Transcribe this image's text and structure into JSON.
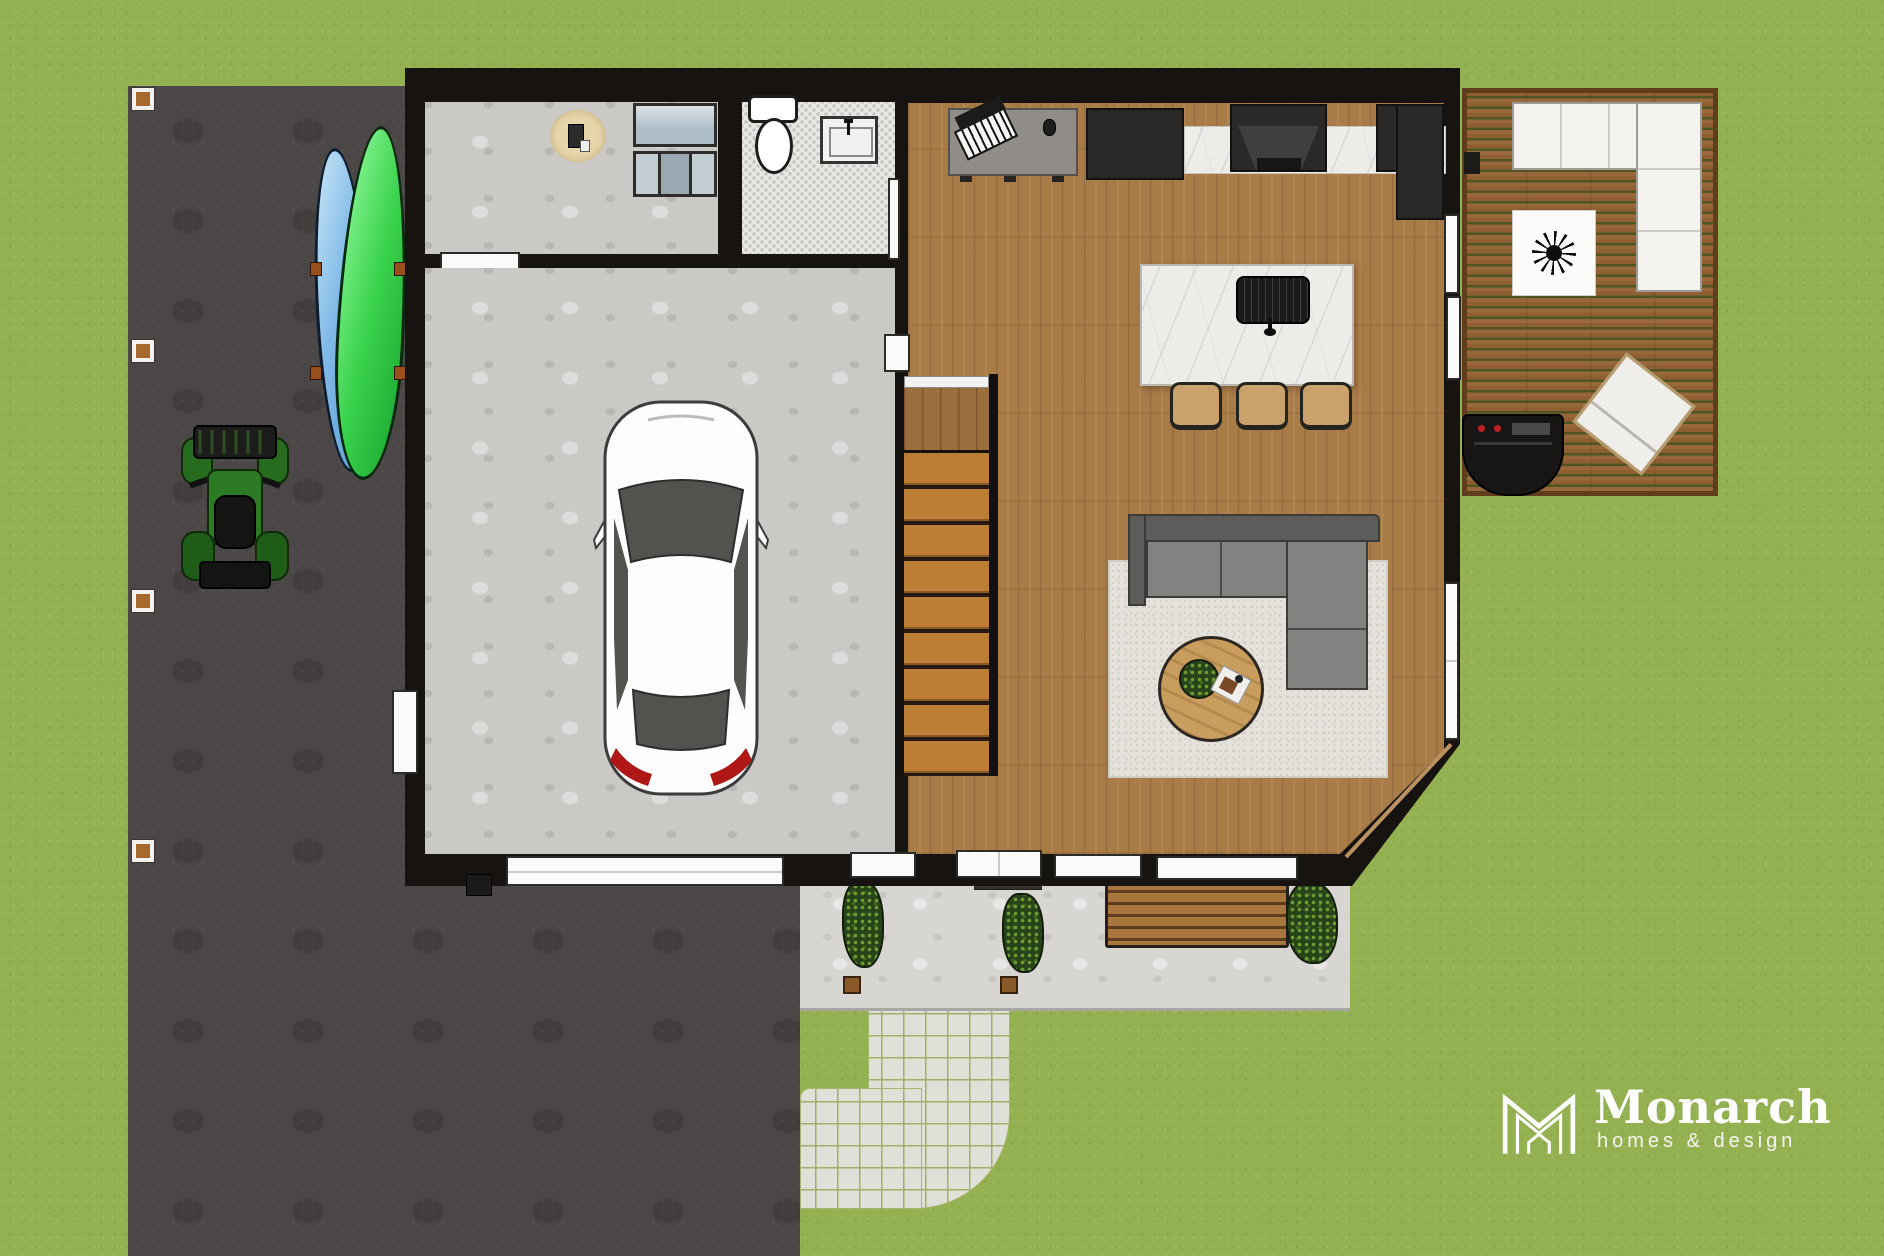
{
  "branding": {
    "logo_name": "Monarch",
    "logo_tagline": "homes & design",
    "logo_mark": "m-house-monogram-icon",
    "text_color": "#ffffff"
  },
  "palette": {
    "grass": "#94b151",
    "driveway_asphalt": "#4b4747",
    "wall_black": "#171311",
    "garage_concrete": "#cbc9c6",
    "porch_concrete": "#d8d6d2",
    "hardwood_floor": "#a87b47",
    "stair_tread": "#bc7e34",
    "bath_tile": "#e8e6e2",
    "marble_counter": "#edece9",
    "deck_planks": "#8f5e31",
    "sofa_gray": "#828280",
    "area_rug": "#e4e1da",
    "coffee_table_wood": "#c99d5e",
    "kayak_blue": "#7fb9e6",
    "kayak_green": "#3bd34d",
    "atv_green": "#2d7a24",
    "car_white": "#fdfdfd",
    "taillight_red": "#b01818"
  },
  "scene": {
    "type": "top-down 3d rendered first-floor plan",
    "rooms": [
      {
        "name": "garage",
        "floor": "concrete"
      },
      {
        "name": "mudroom-laundry",
        "floor": "concrete"
      },
      {
        "name": "powder-bathroom",
        "floor": "penny-tile"
      },
      {
        "name": "kitchen-dining",
        "floor": "hardwood"
      },
      {
        "name": "living-room",
        "floor": "hardwood"
      },
      {
        "name": "staircase",
        "floor": "wood-treads"
      }
    ],
    "exterior": [
      "lawn",
      "asphalt-driveway",
      "paver-walkway",
      "front-porch",
      "rear-deck"
    ],
    "objects": [
      "white-car",
      "green-atv",
      "blue-kayak",
      "green-kayak",
      "washer-dryer",
      "toilet",
      "vanity-sink",
      "round-mat",
      "desk-with-keyboard",
      "refrigerator",
      "range-with-hood",
      "island-with-sink",
      "bar-stools",
      "sectional-sofa",
      "round-coffee-table",
      "area-rug",
      "outdoor-sectional",
      "plant-starburst",
      "lounge-chair",
      "bbq-grill",
      "garden-bench",
      "planter-boxes",
      "door-mat",
      "sliding-glass-door",
      "garage-door",
      "front-door",
      "windows",
      "driveway-posts"
    ],
    "counts": {
      "bar_stools": 3,
      "stair_treads": 9,
      "driveway_posts": 4,
      "porch_planters": 3
    }
  }
}
